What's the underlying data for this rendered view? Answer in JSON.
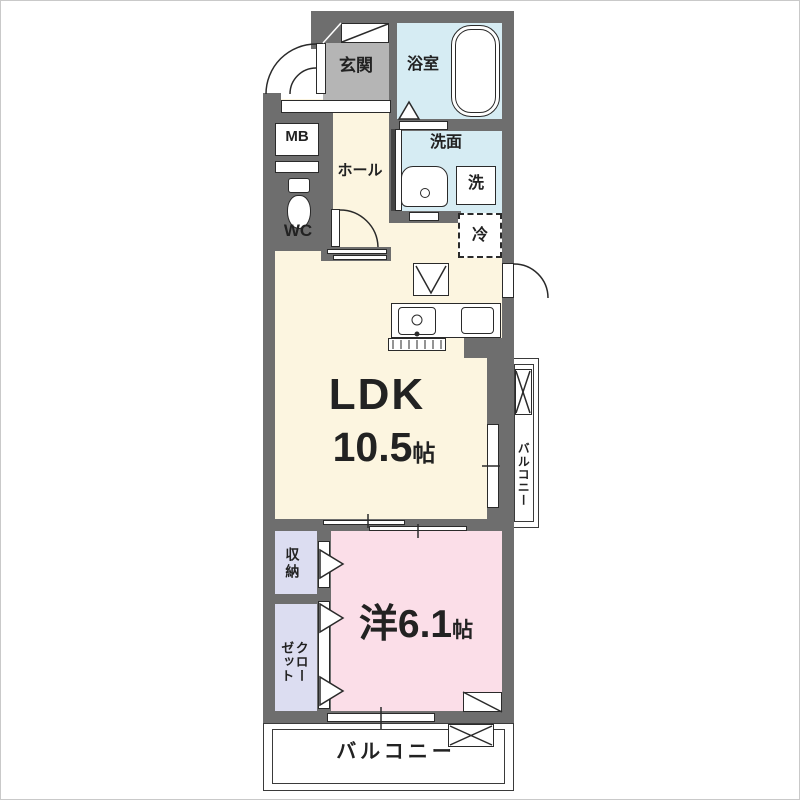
{
  "floor_plan": {
    "rooms": {
      "entrance": {
        "label": "玄関"
      },
      "bathroom": {
        "label": "浴室"
      },
      "meter_box": {
        "label": "MB"
      },
      "hall": {
        "label": "ホール"
      },
      "washroom": {
        "label": "洗面"
      },
      "washer": {
        "label": "洗"
      },
      "toilet": {
        "label": "WC"
      },
      "refrigerator": {
        "label": "冷"
      },
      "ldk": {
        "name": "LDK",
        "size_value": "10.5",
        "size_unit": "帖"
      },
      "storage": {
        "label": "収納"
      },
      "closet": {
        "label": "クロー\nゼット"
      },
      "western_room": {
        "name": "洋6.1",
        "size_unit": "帖"
      },
      "balcony_side": {
        "label": "バルコニー"
      },
      "balcony_bottom": {
        "label": "バルコニー"
      }
    },
    "colors": {
      "wall": "#6e6e6e",
      "entrance_floor": "#b5b5b5",
      "wet_area_floor": "#d6ecf3",
      "ldk_floor": "#fcf5e0",
      "closet_floor": "#dcddf1",
      "bedroom_floor": "#fbdee8",
      "outline": "#222222"
    },
    "symbols": [
      "bathtub-icon",
      "toilet-icon",
      "vanity-sink-icon",
      "kitchen-sink-icon",
      "gas-range-icon",
      "range-hood-icon",
      "refrigerator-space-icon",
      "door-swing-arc",
      "sliding-door",
      "window",
      "folding-door-triangle",
      "balcony-hatch-box",
      "shoe-cabinet-icon"
    ]
  }
}
